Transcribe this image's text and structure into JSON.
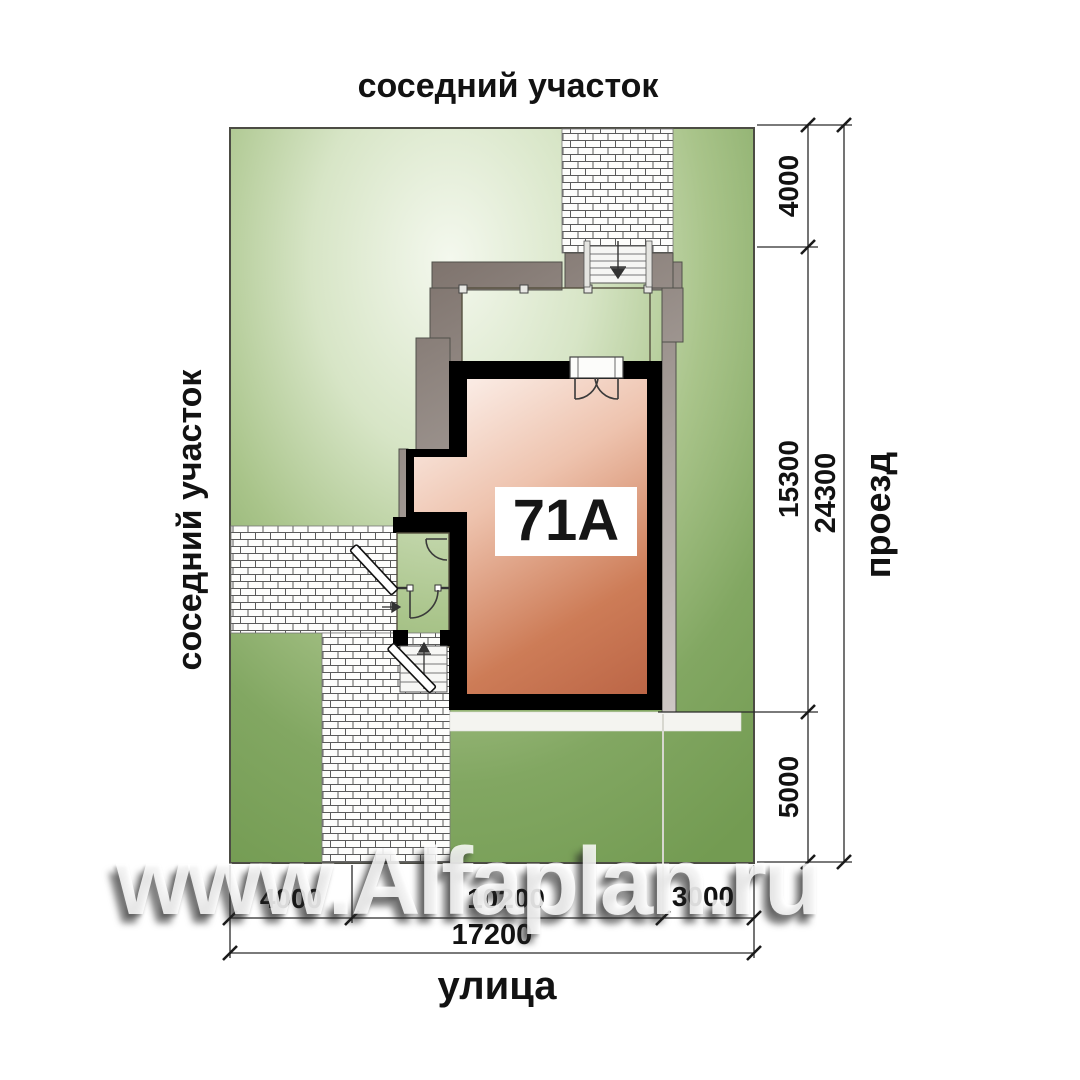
{
  "labels": {
    "neighbor_top": "соседний участок",
    "neighbor_left": "соседний участок",
    "road_right": "проезд",
    "street_bottom": "улица",
    "house_number": "71А"
  },
  "dimensions": {
    "right": {
      "seg1": "4000",
      "seg2": "15300",
      "seg3": "5000",
      "total": "24300"
    },
    "bottom": {
      "seg1": "4000",
      "seg2": "10200",
      "seg3": "3000",
      "total": "17200"
    }
  },
  "watermark": {
    "text": "www.Alfaplan.ru"
  },
  "colors": {
    "plot_green_edge": "#7aa05a",
    "plot_green_light": "#f2f6ea",
    "house_wall": "#000000",
    "house_fill_dark": "#bd6545",
    "house_fill_light": "#fdf3ee",
    "terrace_cream": "#eedcab",
    "vestibule_cream": "#e9d194",
    "blind_area_gray": "#847a76",
    "brick_joint": "#5a5a5a",
    "dimension_text": "#121212",
    "watermark_white": "#ffffff"
  }
}
